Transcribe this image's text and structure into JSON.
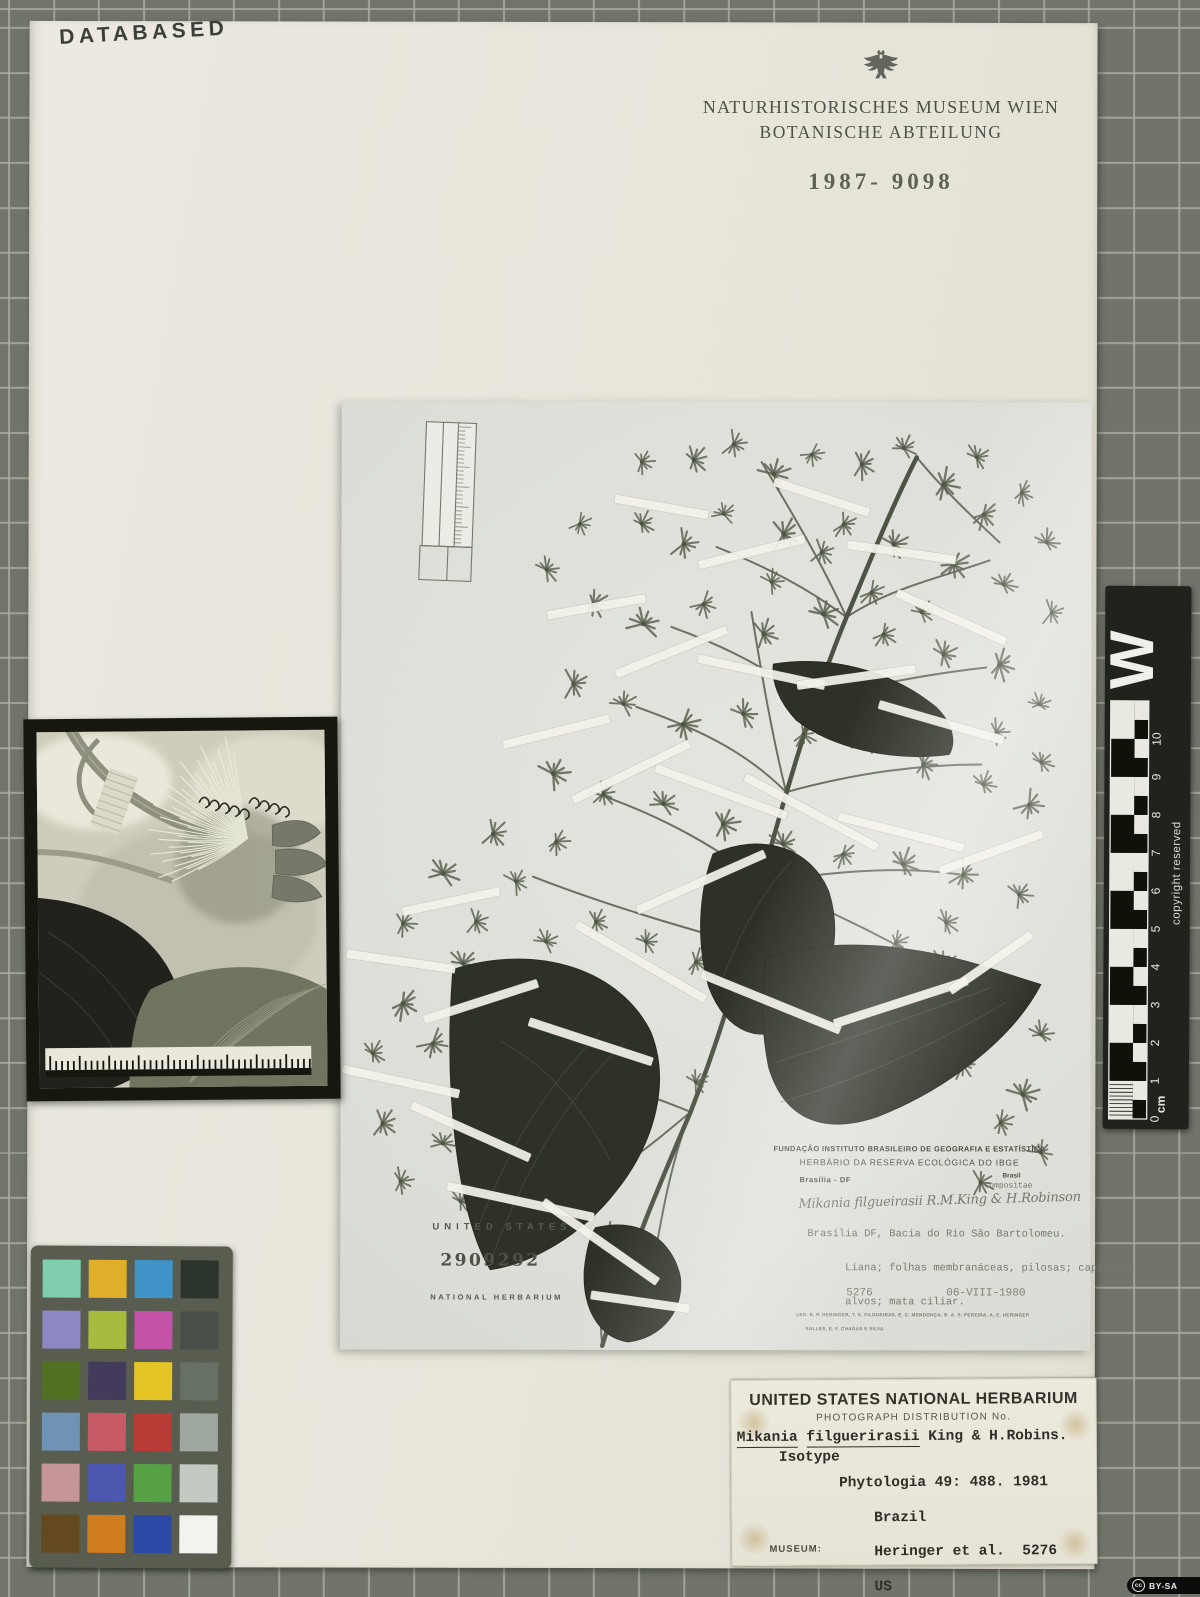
{
  "stamps": {
    "databased": "DATABASED"
  },
  "header": {
    "eagle_icon": "austrian-eagle",
    "museum_line1": "NATURHISTORISCHES MUSEUM WIEN",
    "museum_line2": "BOTANISCHE ABTEILUNG",
    "accession_number": "1987- 9098"
  },
  "specimen_photo": {
    "us_stamp": {
      "country": "UNITED STATES",
      "barcode_number": "2909292",
      "institution": "NATIONAL HERBARIUM"
    },
    "ibge_label": {
      "org_line1": "FUNDAÇÃO INSTITUTO BRASILEIRO DE GEOGRAFIA E ESTATÍSTICA",
      "org_line2": "HERBÁRIO DA RESERVA ECOLÓGICA DO IBGE",
      "locality": "Brasília - DF",
      "country": "Brasil",
      "family": "Compositae",
      "handwritten_name": "Mikania filgueirasii R.M.King & H.Robinson",
      "description_line1": "Brasília DF, Bacia do Rio São Bartolomeu.",
      "description_line2": "Liana; folhas membranáceas, pilosas; capítulos",
      "description_line3": "alvos; mata ciliar.",
      "collector_number": "5276",
      "date": "06-VIII-1980",
      "collectors_line1": "LEG. E. P. HERINGER, T. S. FILGUEIRAS, E. C. MENDONÇA, B. A. S. PEREIRA, A. E. HERINGER",
      "collectors_line2": "SALLES, E. F. CHAGAS E SILVA."
    }
  },
  "usnh_label": {
    "title": "UNITED STATES NATIONAL HERBARIUM",
    "subtitle": "PHOTOGRAPH DISTRIBUTION No.",
    "genus": "Mikania",
    "epithet": "filguerirasii",
    "authors": " King & H.Robins.",
    "type_status": "Isotype",
    "citation": "Phytologia 49: 488. 1981",
    "country": "Brazil",
    "collectors": "Heringer et al.  5276",
    "herbarium_code": "US",
    "museum_field_label": "MUSEUM:"
  },
  "ruler": {
    "brand_letter": "W",
    "copyright_text": "copyright reserved",
    "unit_label": "cm",
    "numbers": [
      "0",
      "1",
      "2",
      "3",
      "4",
      "5",
      "6",
      "7",
      "8",
      "9",
      "10"
    ]
  },
  "color_chart": {
    "rows": 6,
    "cols": 4,
    "patch_colors": [
      "#7fcfae",
      "#dfaf2a",
      "#3f93c6",
      "#2c352c",
      "#8d87c3",
      "#a6bc3e",
      "#c453a8",
      "#474f48",
      "#527022",
      "#443a5c",
      "#e5c426",
      "#667064",
      "#6e93b5",
      "#c85a66",
      "#b83b36",
      "#9fa8a0",
      "#c59598",
      "#4c58b0",
      "#57a145",
      "#c3cac2",
      "#64481f",
      "#d07c20",
      "#2c49a5",
      "#f2f2ee"
    ]
  },
  "license_badge": {
    "icon_letters": "cc",
    "text": "BY-SA"
  }
}
